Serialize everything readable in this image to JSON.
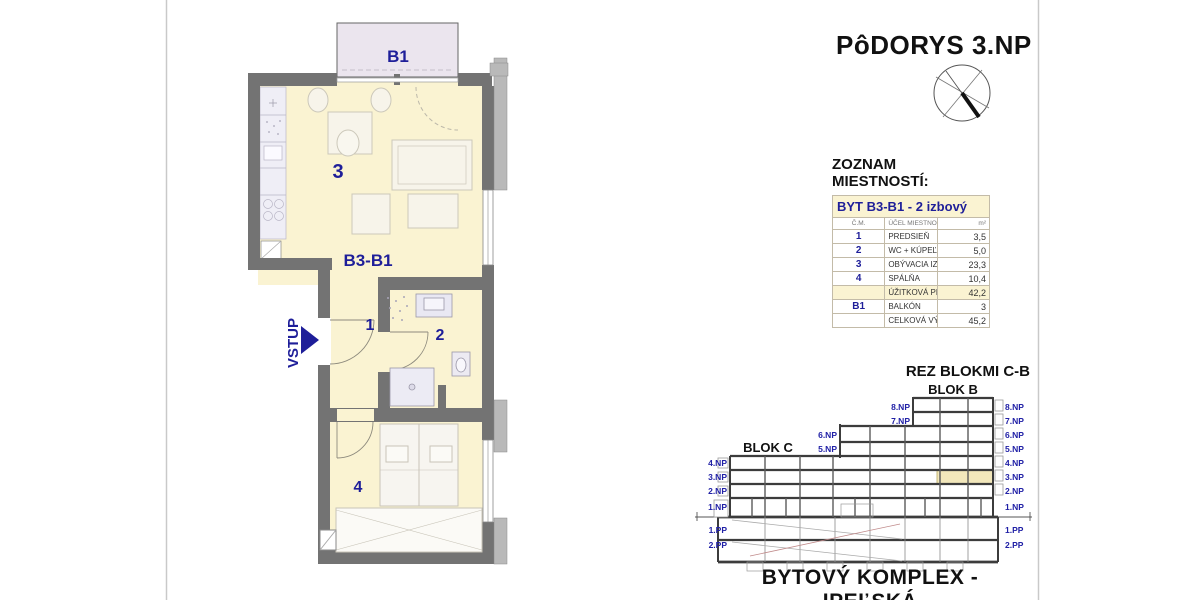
{
  "page": {
    "title": "PôDORYS 3.NP",
    "bottom_title": "BYTOVÝ KOMPLEX - IPEĽSKÁ"
  },
  "plan": {
    "balcony_label": "B1",
    "apartment_label": "B3-B1",
    "entrance_label": "VSTUP",
    "rooms": {
      "hall": "1",
      "bathroom": "2",
      "living": "3",
      "bedroom": "4"
    }
  },
  "room_table": {
    "title": "ZOZNAM MIESTNOSTÍ:",
    "subtitle": "BYT B3-B1 - 2 izbový",
    "columns": [
      "Č.M.",
      "ÚČEL MIESTNOSTI",
      "m²"
    ],
    "rows": [
      {
        "num": "1",
        "name": "PREDSIEŇ",
        "area": "3,5"
      },
      {
        "num": "2",
        "name": "WC + KÚPEĽŇA",
        "area": "5,0"
      },
      {
        "num": "3",
        "name": "OBÝVACIA IZBA S KUCHYŇOU",
        "area": "23,3"
      },
      {
        "num": "4",
        "name": "SPÁLŇA",
        "area": "10,4"
      },
      {
        "num": "",
        "name": "ÚŽITKOVÁ PLOCHA BYTU",
        "area": "42,2"
      },
      {
        "num": "B1",
        "name": "BALKÓN",
        "area": "3"
      },
      {
        "num": "",
        "name": "CELKOVÁ VÝMERA BYTU",
        "area": "45,2"
      }
    ]
  },
  "section": {
    "title": "REZ BLOKMI C-B",
    "block_c_label": "BLOK C",
    "block_b_label": "BLOK B",
    "left_labels": [
      "4.NP",
      "3.NP",
      "2.NP",
      "1.NP",
      "1.PP",
      "2.PP"
    ],
    "mid_labels": [
      "6.NP",
      "5.NP"
    ],
    "tower_labels": [
      "8.NP",
      "7.NP"
    ],
    "right_labels": [
      "8.NP",
      "7.NP",
      "6.NP",
      "5.NP",
      "4.NP",
      "3.NP",
      "2.NP",
      "1.NP",
      "1.PP",
      "2.PP"
    ]
  },
  "colors": {
    "room_fill": "#faf3d2",
    "balcony_fill": "#ebe5ee",
    "wall_dark": "#737373",
    "wall_light": "#b9b9b9",
    "label_blue": "#1e1e99",
    "section_highlight": "#f2e7bb"
  }
}
